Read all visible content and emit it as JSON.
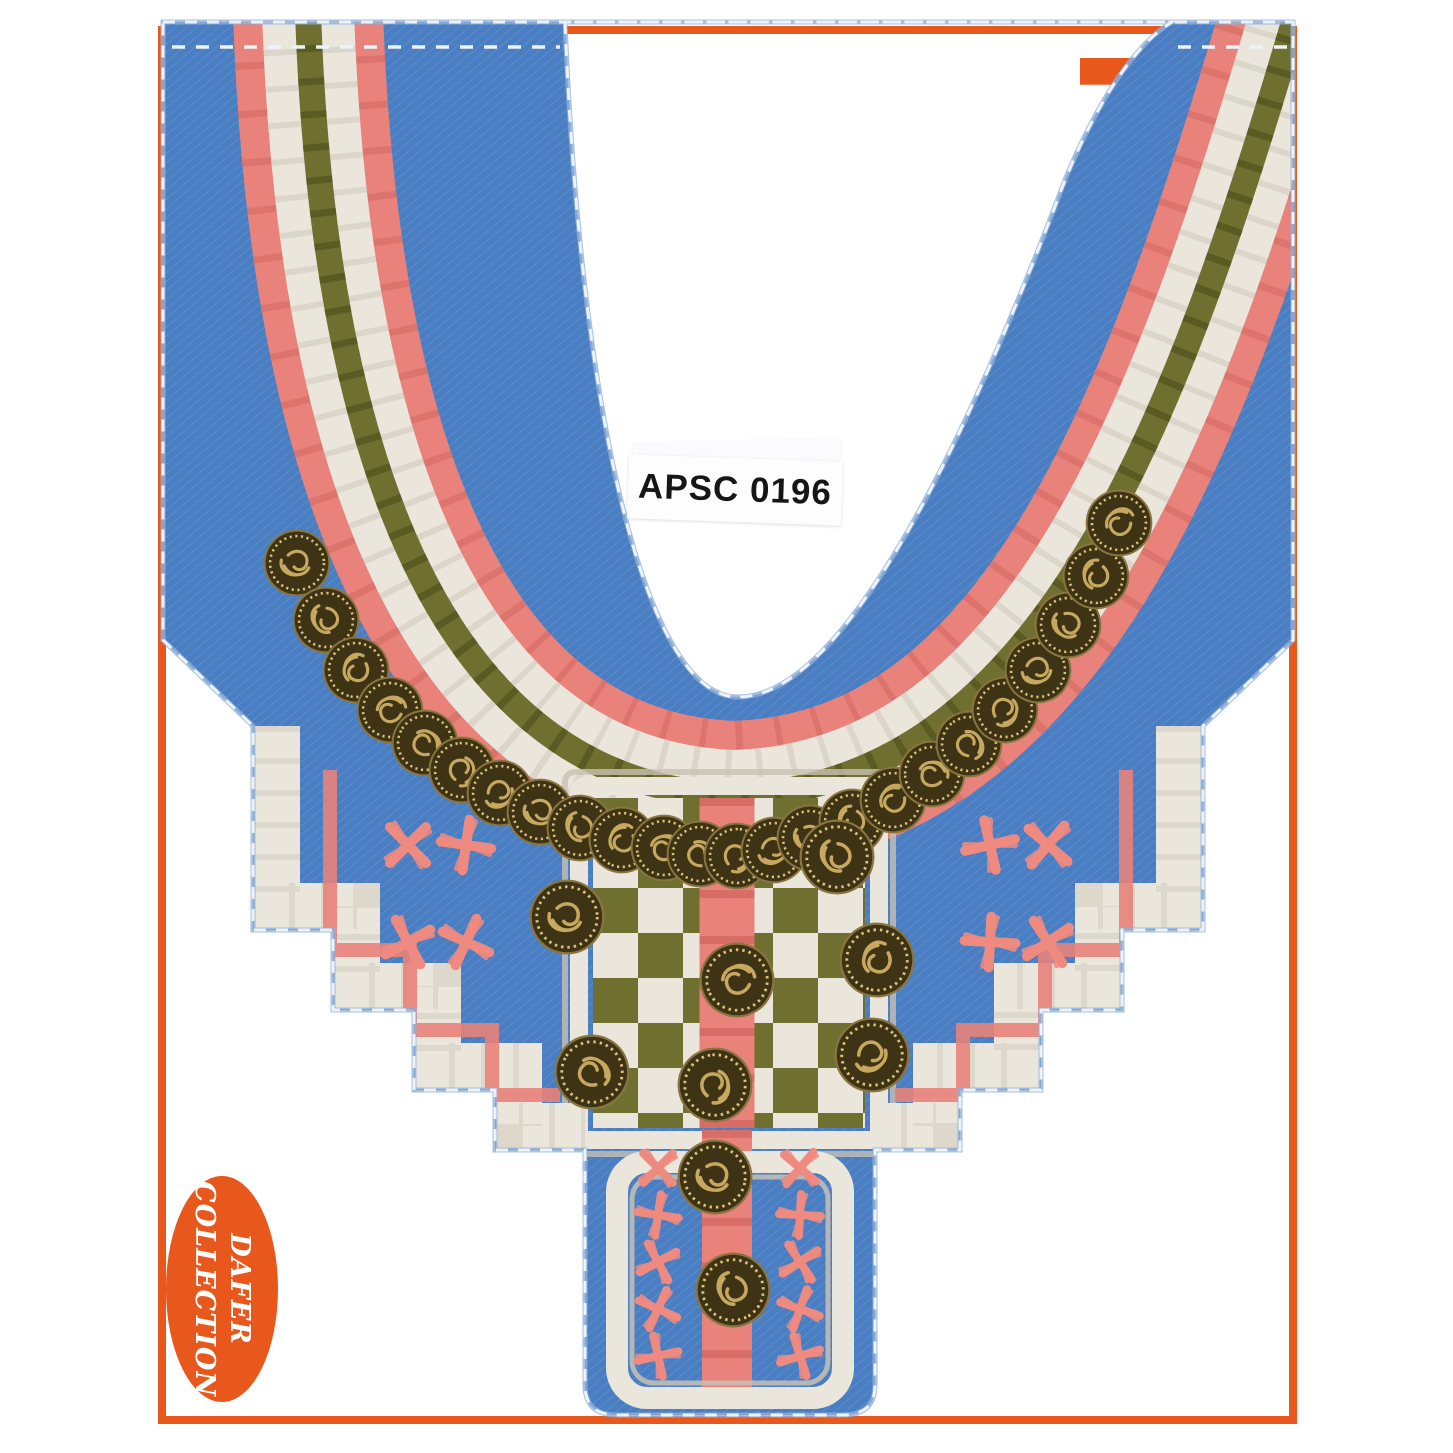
{
  "photo": {
    "label_sticker": {
      "text": "APSC 0196"
    },
    "brand_logo": {
      "initial": "F",
      "vertical_text": "ernández"
    },
    "collection_badge": {
      "line1": "DAFER",
      "line2": "COLLECTION"
    },
    "colors": {
      "orange": "#e8581c",
      "card_bg": "#f2f1f5",
      "denim": "#4a7ec2",
      "denim_light": "#7fa6d8",
      "coral": "#e8827a",
      "coral_dark": "#c24f4d",
      "cream": "#ebe6dc",
      "silver": "#c8c1b3",
      "olive": "#6f7030",
      "olive_dark": "#474b1a",
      "coin": "#3e3415",
      "coin_gold": "#c6a85f",
      "coin_rim": "#dcc47d",
      "pink": "#ee8a80",
      "stitch": "#eef3fa",
      "fringe": "#8fb0da"
    },
    "fabric": {
      "arc_coins": [
        [
          297,
          563
        ],
        [
          326,
          620
        ],
        [
          356,
          670
        ],
        [
          390,
          710
        ],
        [
          425,
          743
        ],
        [
          462,
          770
        ],
        [
          500,
          793
        ],
        [
          540,
          812
        ],
        [
          580,
          828
        ],
        [
          622,
          840
        ],
        [
          664,
          848
        ],
        [
          700,
          854
        ],
        [
          737,
          856
        ],
        [
          774,
          850
        ],
        [
          810,
          838
        ],
        [
          852,
          822
        ],
        [
          893,
          800
        ],
        [
          932,
          774
        ],
        [
          969,
          744
        ],
        [
          1005,
          710
        ],
        [
          1038,
          670
        ],
        [
          1068,
          625
        ],
        [
          1096,
          576
        ],
        [
          1119,
          523
        ]
      ],
      "scatter_coins": [
        [
          567,
          917
        ],
        [
          837,
          857
        ],
        [
          877,
          960
        ],
        [
          737,
          980
        ],
        [
          592,
          1072
        ],
        [
          715,
          1085
        ],
        [
          872,
          1055
        ],
        [
          715,
          1177
        ],
        [
          733,
          1290
        ]
      ],
      "wing_crosses": [
        [
          408,
          845
        ],
        [
          466,
          845
        ],
        [
          408,
          942
        ],
        [
          466,
          942
        ],
        [
          990,
          845
        ],
        [
          1048,
          845
        ],
        [
          990,
          942
        ],
        [
          1048,
          942
        ]
      ],
      "box_crosses": [
        [
          658,
          1168
        ],
        [
          658,
          1215
        ],
        [
          658,
          1262
        ],
        [
          658,
          1309
        ],
        [
          658,
          1356
        ],
        [
          800,
          1168
        ],
        [
          800,
          1215
        ],
        [
          800,
          1262
        ],
        [
          800,
          1309
        ],
        [
          800,
          1356
        ]
      ]
    }
  }
}
